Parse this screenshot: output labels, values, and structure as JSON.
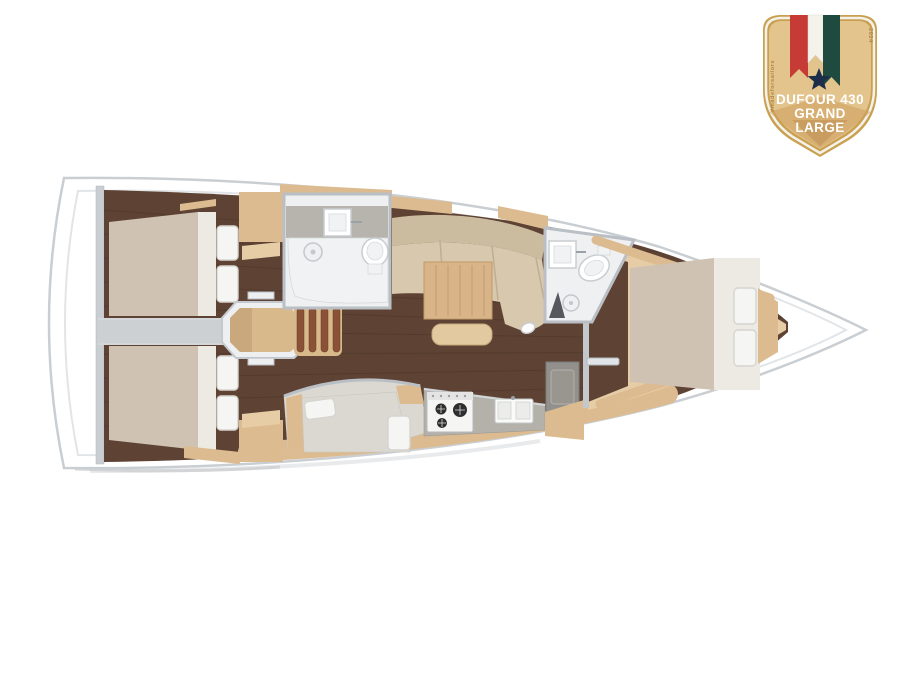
{
  "badge": {
    "title_line1": "DUFOUR 430",
    "title_line2": "GRAND",
    "title_line3": "LARGE",
    "left_vertical_text": "#madeforsailors",
    "right_vertical_text": "2024"
  },
  "palette": {
    "hull_fill": "#ffffff",
    "hull_stroke": "#c9ced3",
    "deck_line": "#e2e5e8",
    "wood_dark": "#5e4334",
    "wood_light": "#dcbb90",
    "wood_light2": "#e6cda6",
    "mattress": "#cfc2b2",
    "mattress_light": "#dbd8d2",
    "sheet": "#edeae3",
    "pillow": "#f5f5f3",
    "pillow_shade": "#d5d4cf",
    "sofa": "#d7c8ae",
    "sofa_back": "#ccbc9f",
    "table_wood": "#d9b488",
    "counter": "#b4b1ab",
    "bath_floor": "#eef0f1",
    "wall": "#b9bfc5",
    "wall_light": "#d3d7da",
    "corridor": "#ccd0d3",
    "steel": "#9aa2a8",
    "badge_gold": "#e3c48d",
    "badge_border": "#c9a050",
    "badge_red": "#c63b35",
    "badge_green": "#1e4a40",
    "badge_navy": "#1d2e4a",
    "badge_text": "#ffffff",
    "badge_side_text": "#b08644"
  }
}
